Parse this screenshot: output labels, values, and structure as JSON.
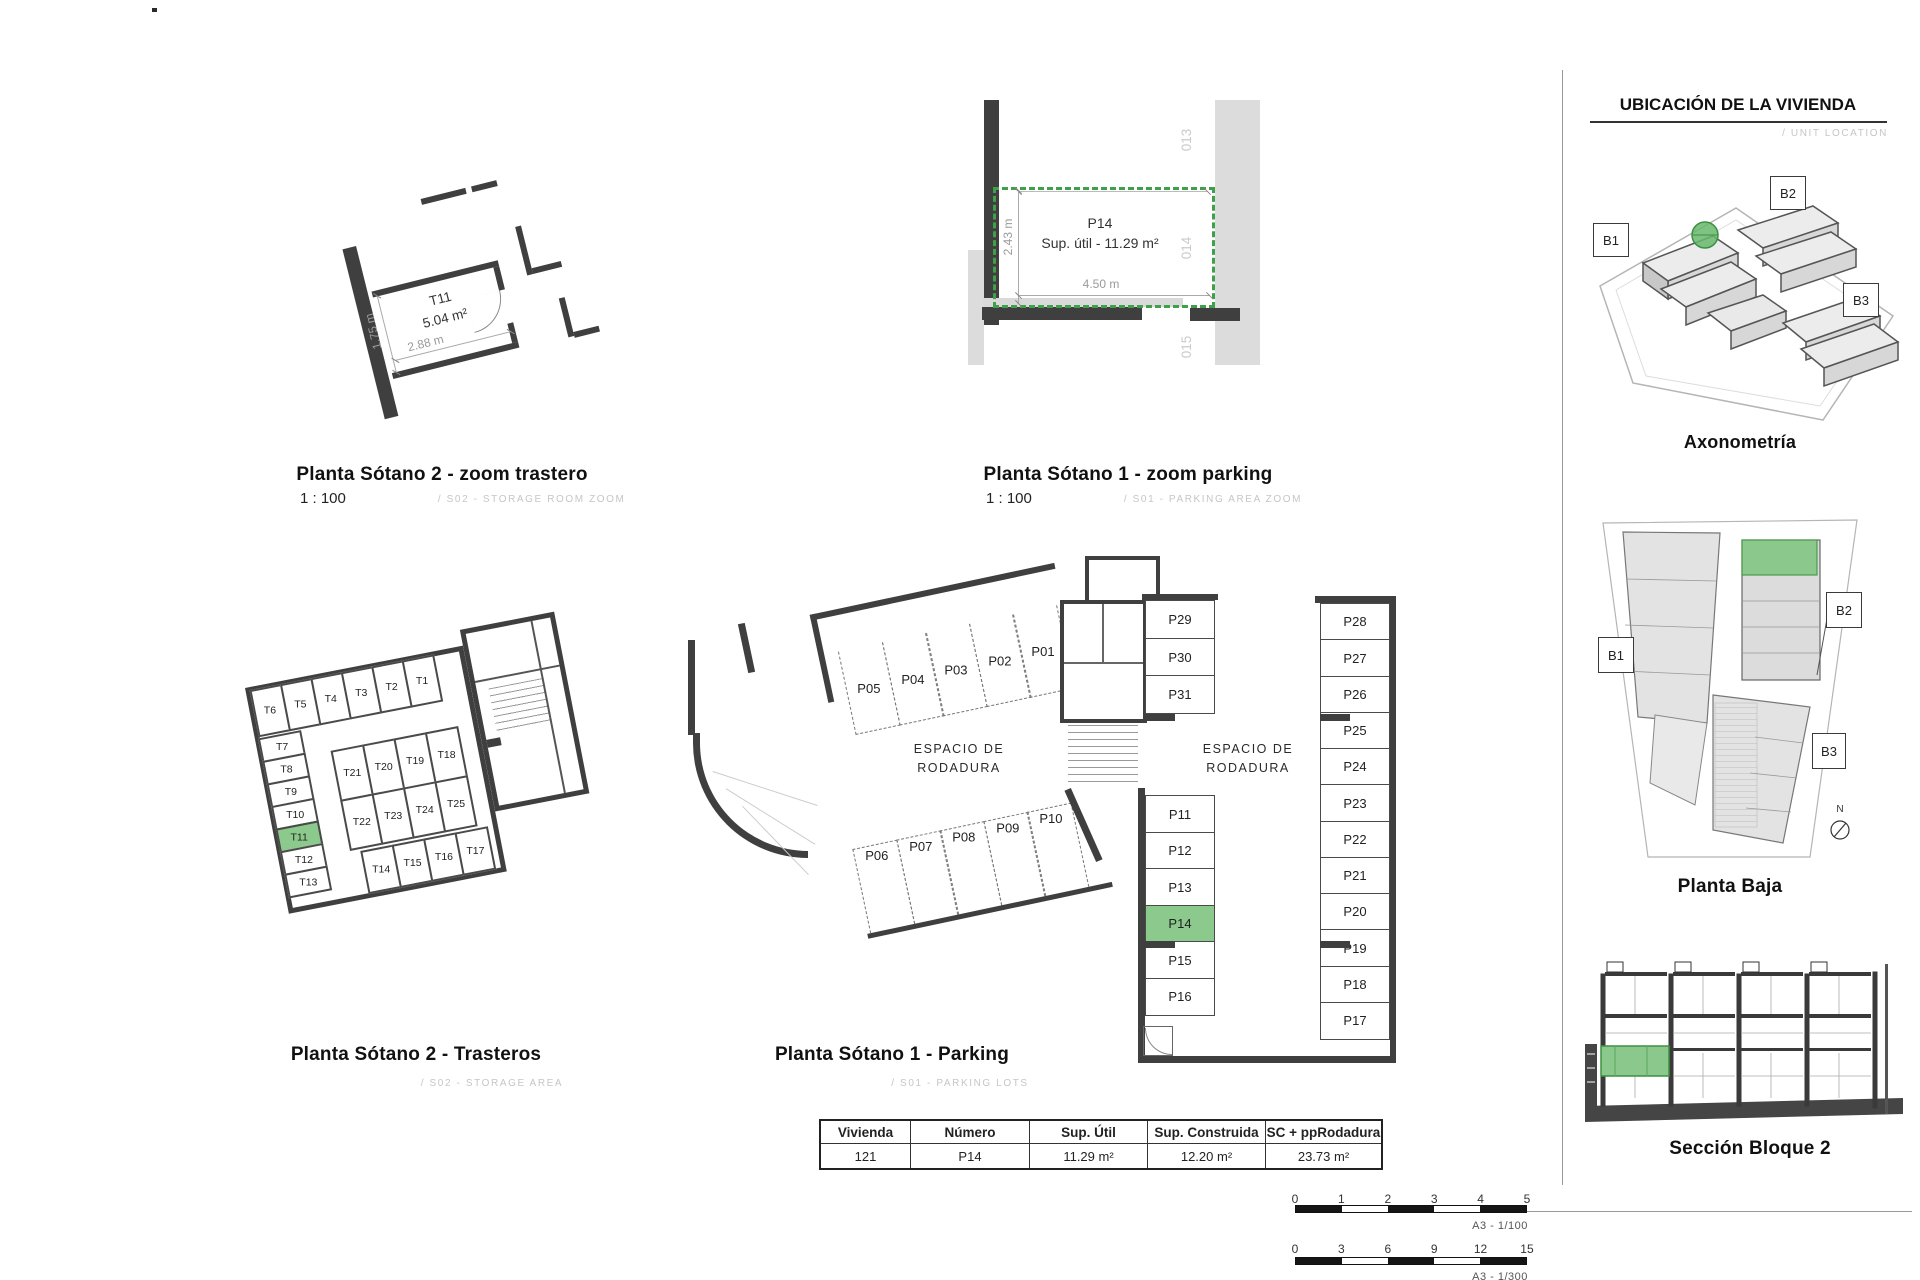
{
  "sheet": {
    "details": {
      "trastero": {
        "title": "Planta Sótano 2 - zoom trastero",
        "scale": "1 : 100",
        "code": "/ S02 - STORAGE ROOM ZOOM",
        "room_id": "T11",
        "room_area": "5.04 m²",
        "dim_width": "2.88 m",
        "dim_depth": "1.75 m"
      },
      "parking": {
        "title": "Planta Sótano 1 - zoom parking",
        "scale": "1 : 100",
        "code": "/ S01 - PARKING AREA ZOOM",
        "space_id": "P14",
        "space_area": "Sup. útil - 11.29 m²",
        "dim_width": "4.50 m",
        "dim_depth": "2.43 m",
        "adjacent": [
          "013",
          "014",
          "015"
        ]
      }
    },
    "plans": {
      "trasteros": {
        "title": "Planta Sótano 2 - Trasteros",
        "code": "/ S02 - STORAGE AREA",
        "highlight": "T11",
        "top_row": [
          "T6",
          "T5",
          "T4",
          "T3",
          "T2",
          "T1"
        ],
        "left_col": [
          "T7",
          "T8",
          "T9",
          "T10",
          "T11",
          "T12",
          "T13"
        ],
        "inner_top": [
          "T21",
          "T20",
          "T19",
          "T18"
        ],
        "inner_bottom": [
          "T22",
          "T23",
          "T24",
          "T25"
        ],
        "bottom_row": [
          "T14",
          "T15",
          "T16",
          "T17"
        ]
      },
      "parking": {
        "title": "Planta Sótano 1 - Parking",
        "code": "/ S01 - PARKING LOTS",
        "highlight": "P14",
        "area_label": "ESPACIO DE RODADURA",
        "row_top": [
          "P05",
          "P04",
          "P03",
          "P02",
          "P01"
        ],
        "row_mid": [
          "P06",
          "P07",
          "P08",
          "P09",
          "P10"
        ],
        "col_inner_upper": [
          "P29",
          "P30",
          "P31"
        ],
        "col_inner_lower": [
          "P11",
          "P12",
          "P13",
          "P14",
          "P15",
          "P16"
        ],
        "col_right": [
          "P28",
          "P27",
          "P26",
          "P25",
          "P24",
          "P23",
          "P22",
          "P21",
          "P20",
          "P19",
          "P18",
          "P17"
        ]
      }
    },
    "location": {
      "header": "UBICACIÓN DE LA VIVIENDA",
      "header_sub": "/ UNIT LOCATION",
      "axo_title": "Axonometría",
      "axo_labels": [
        "B1",
        "B2",
        "B3"
      ],
      "plan_title": "Planta Baja",
      "plan_labels": [
        "B1",
        "B2",
        "B3"
      ],
      "compass": "N",
      "section_title": "Sección Bloque 2"
    },
    "table": {
      "headers": [
        "Vivienda",
        "Número",
        "Sup. Útil",
        "Sup. Construida",
        "SC + ppRodadura"
      ],
      "values": [
        "121",
        "P14",
        "11.29 m²",
        "12.20 m²",
        "23.73 m²"
      ]
    },
    "scalebars": [
      {
        "ticks": [
          "0",
          "1",
          "2",
          "3",
          "4",
          "5"
        ],
        "label": "A3 - 1/100"
      },
      {
        "ticks": [
          "0",
          "3",
          "6",
          "9",
          "12",
          "15"
        ],
        "label": "A3 - 1/300"
      }
    ],
    "colors": {
      "highlight_fill": "#8cc98c",
      "highlight_stroke": "#4a9a4e",
      "dashed_green": "#3fa04a",
      "wall": "#3f3f3f"
    }
  }
}
